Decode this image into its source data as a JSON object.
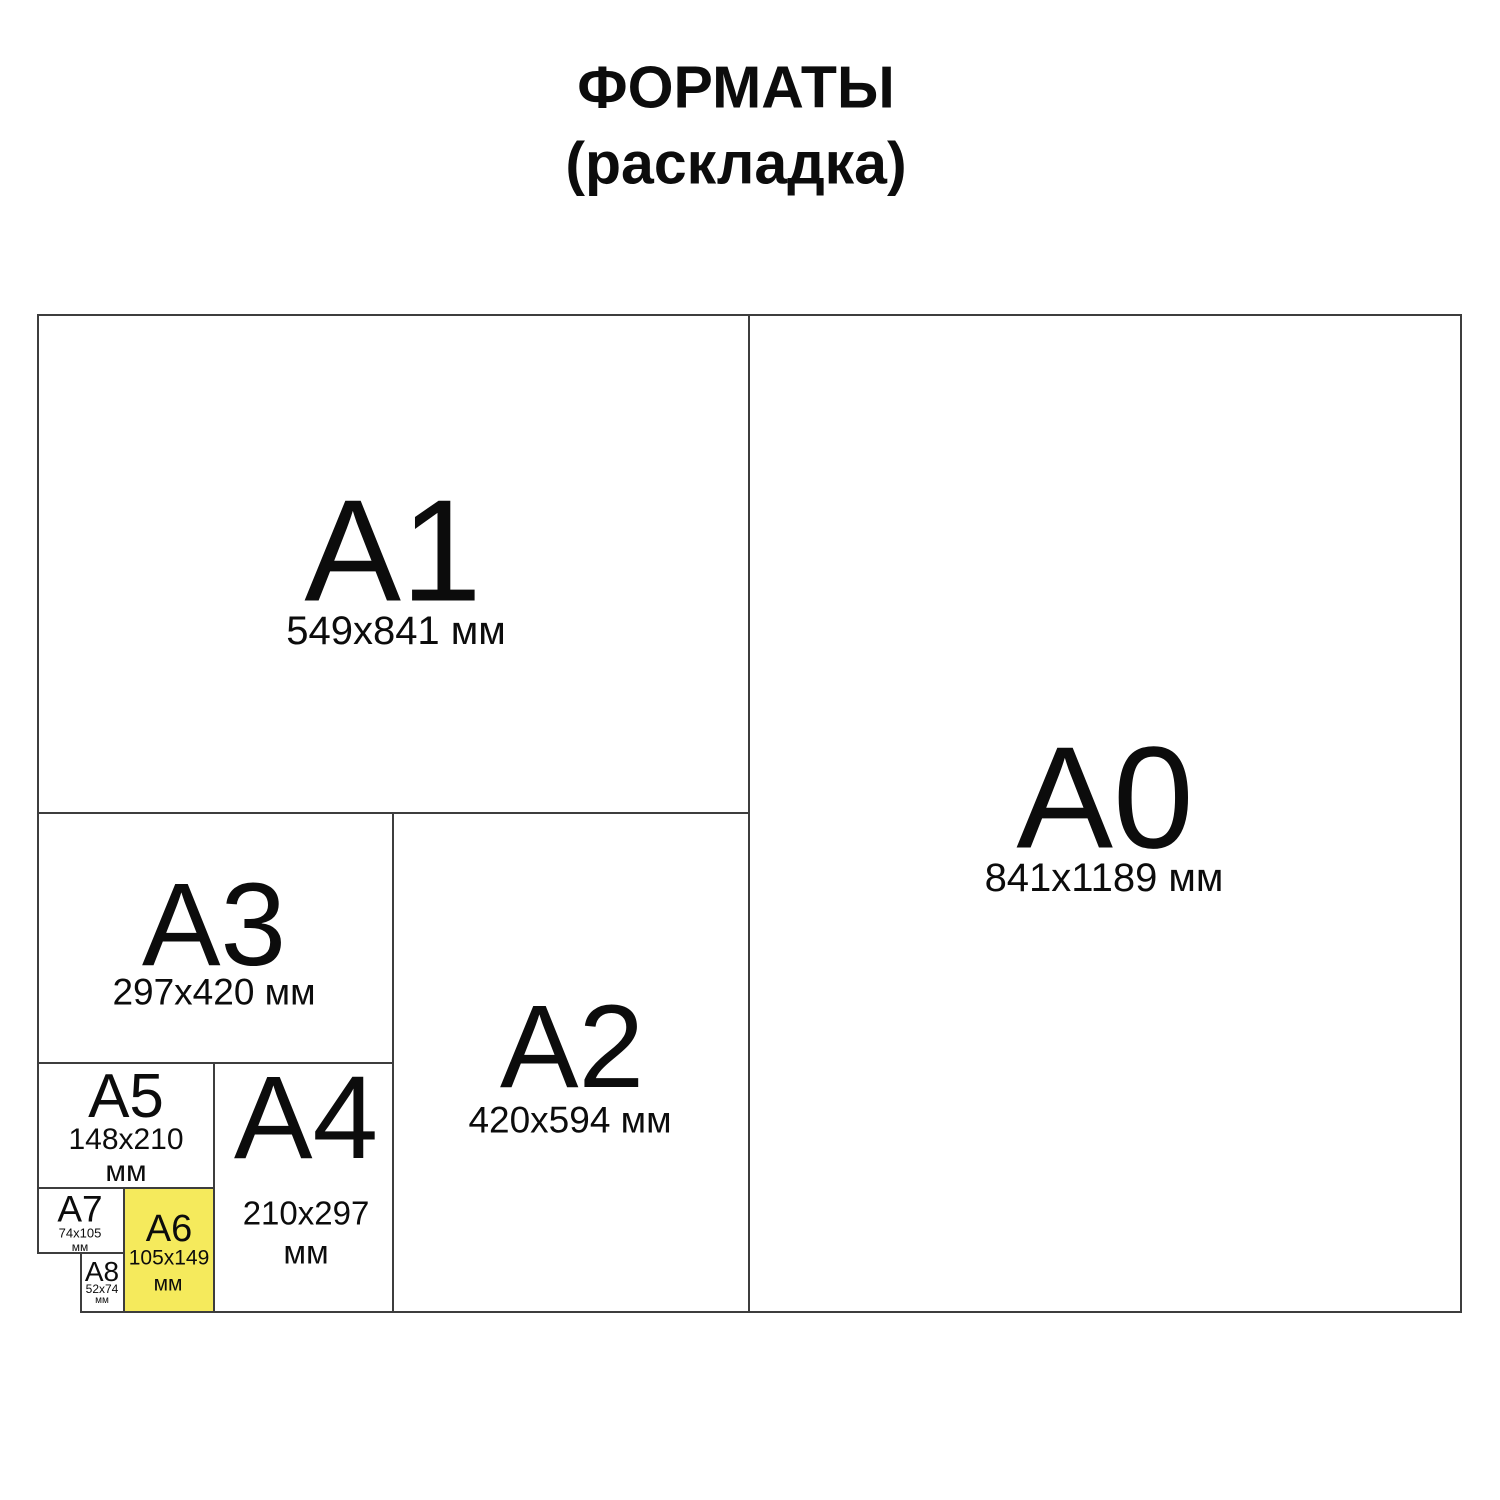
{
  "title": {
    "line1": "ФОРМАТЫ",
    "line2": "(раскладка)"
  },
  "colors": {
    "highlight": "#F5EA5C",
    "line": "#3d3d3d",
    "text": "#0c0c0c",
    "background": "#FFFFFF"
  },
  "formats": {
    "a0": {
      "label": "A0",
      "size": "841x1189 мм"
    },
    "a1": {
      "label": "A1",
      "size": "549x841 мм"
    },
    "a2": {
      "label": "A2",
      "size": "420x594 мм"
    },
    "a3": {
      "label": "A3",
      "size": "297x420 мм"
    },
    "a4": {
      "label": "A4",
      "size_line1": "210x297",
      "size_line2": "мм"
    },
    "a5": {
      "label": "A5",
      "size_line1": "148x210",
      "size_line2": "мм"
    },
    "a6": {
      "label": "A6",
      "size_line1": "105x149",
      "size_line2": "мм",
      "highlighted": true
    },
    "a7": {
      "label": "A7",
      "size_line1": "74x105",
      "size_line2": "мм"
    },
    "a8": {
      "label": "A8",
      "size_line1": "52x74",
      "size_line2": "мм"
    }
  }
}
